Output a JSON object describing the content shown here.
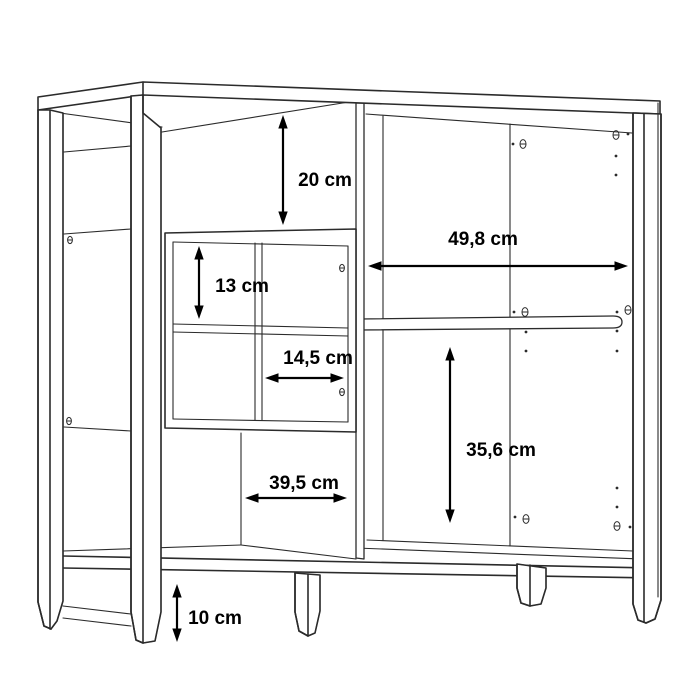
{
  "diagram": {
    "type": "furniture-dimension-diagram",
    "colors": {
      "background": "#ffffff",
      "line": "#2b2b2b",
      "dimension": "#000000"
    },
    "measurements": {
      "top_opening_height": "20 cm",
      "cubby_cell_height": "13 cm",
      "cubby_cell_width": "14,5 cm",
      "right_opening_width": "49,8 cm",
      "right_opening_height": "35,6 cm",
      "left_opening_width": "39,5 cm",
      "leg_height": "10 cm"
    }
  }
}
